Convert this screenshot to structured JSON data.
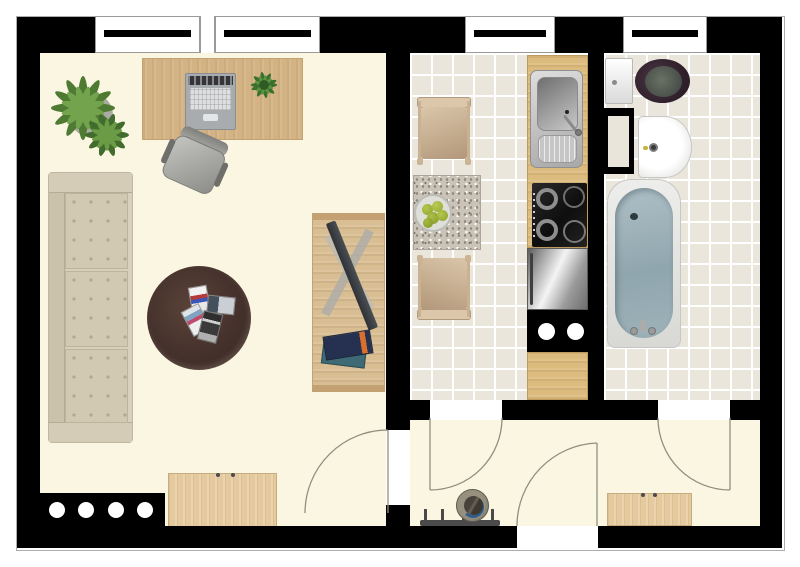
{
  "floorplan": {
    "type": "apartment-floor-plan-top-view",
    "window_count": 4,
    "door_count": 4,
    "colors": {
      "wall": "#000000",
      "living_floor": "#FBF6E1",
      "tile_floor": "#EAE6DC",
      "tile_grout": "#FFFFFF",
      "wood_desk": "#D3B384",
      "wood_counter": "#DCBB7E",
      "wood_sideboard": "#E4CA9E",
      "sofa": "#D2C9B2",
      "coffee_table": "#43302B",
      "bathtub_water": "#9FB3BA",
      "toilet_seat": "#36252F",
      "stainless": "#B9B9B9",
      "apples": "#9CB23C",
      "door_arc": "#90907E"
    },
    "rooms": [
      {
        "id": "living-room",
        "label": "Living room",
        "furniture": [
          "potted plant",
          "desk",
          "laptop",
          "desk plant",
          "office chair",
          "sofa",
          "round coffee table",
          "magazines",
          "TV bench",
          "TV",
          "books",
          "sideboard",
          "radiator with 4 vents"
        ]
      },
      {
        "id": "kitchen",
        "label": "Kitchen",
        "furniture": [
          "dining chair (top)",
          "granite dining table",
          "fruit bowl with green apples",
          "dining chair (bottom)",
          "wood counter",
          "stainless sink with drainboard",
          "4-burner cooktop",
          "refrigerator",
          "appliance block with 2 burners",
          "wood counter section"
        ]
      },
      {
        "id": "bathroom",
        "label": "Bathroom",
        "furniture": [
          "toilet with dark seat",
          "duct shaft",
          "washbasin",
          "bathtub"
        ]
      },
      {
        "id": "hallway",
        "label": "Hallway",
        "furniture": [
          "coat rack with hooks",
          "hat",
          "shoe cabinet"
        ]
      }
    ],
    "doors": [
      {
        "id": "living-room-door",
        "swing": "into living room"
      },
      {
        "id": "kitchen-door",
        "swing": "into hallway"
      },
      {
        "id": "bathroom-door",
        "swing": "into hallway"
      },
      {
        "id": "front-door",
        "swing": "into hallway"
      }
    ]
  }
}
